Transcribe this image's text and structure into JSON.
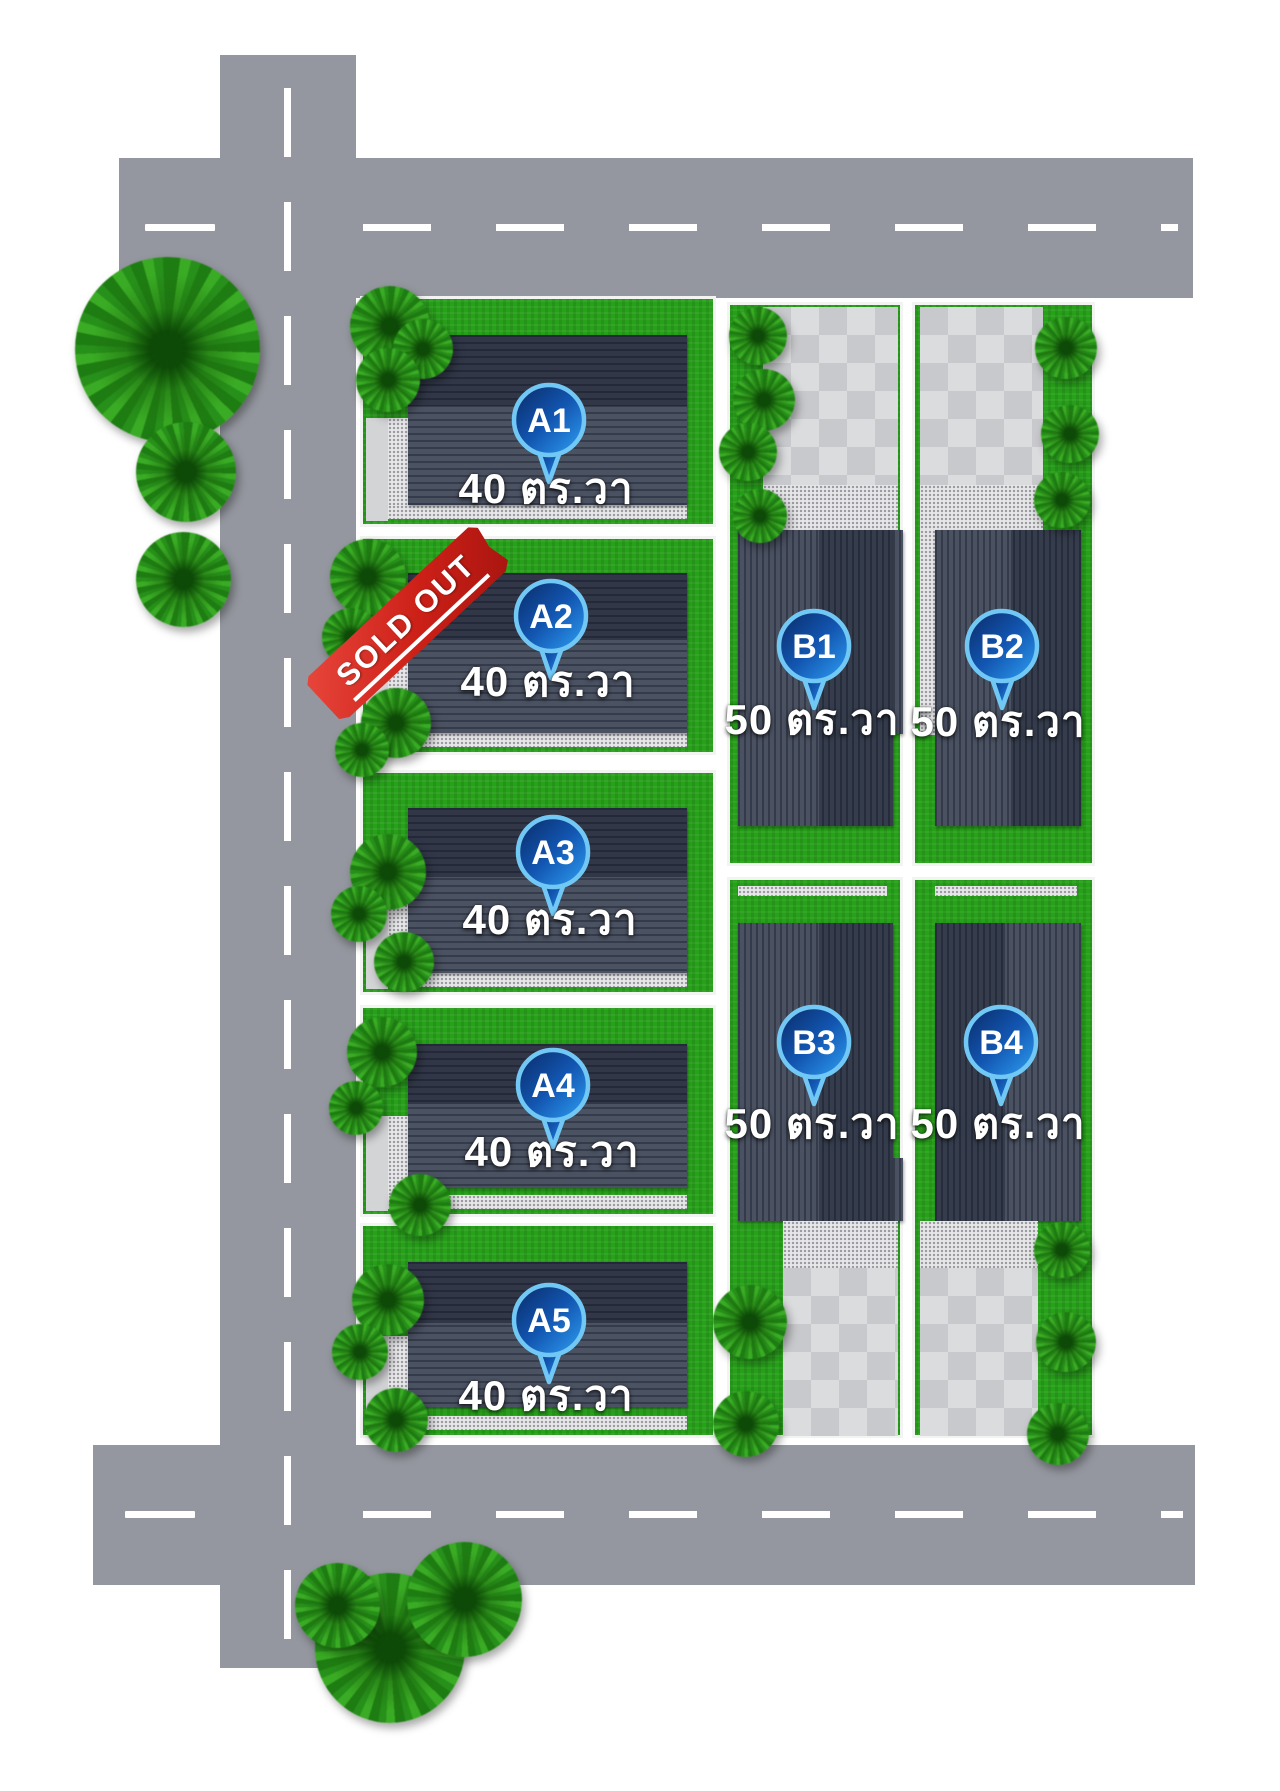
{
  "plan": {
    "type": "housing-project-site-plan",
    "lot_count": 9
  },
  "lots": [
    {
      "id": "A1",
      "area_label": "40 ตร.วา",
      "status": "available"
    },
    {
      "id": "A2",
      "area_label": "40 ตร.วา",
      "status": "sold",
      "banner": "SOLD OUT"
    },
    {
      "id": "A3",
      "area_label": "40 ตร.วา",
      "status": "available"
    },
    {
      "id": "A4",
      "area_label": "40 ตร.วา",
      "status": "available"
    },
    {
      "id": "A5",
      "area_label": "40 ตร.วา",
      "status": "available"
    },
    {
      "id": "B1",
      "area_label": "50 ตร.วา",
      "status": "available"
    },
    {
      "id": "B2",
      "area_label": "50 ตร.วา",
      "status": "available"
    },
    {
      "id": "B3",
      "area_label": "50 ตร.วา",
      "status": "available"
    },
    {
      "id": "B4",
      "area_label": "50 ตร.วา",
      "status": "available"
    }
  ],
  "colors": {
    "road": "#94979f",
    "road_line": "#ffffff",
    "grass": "#27a01a",
    "roof": "#49505e",
    "paving": "#d9dadc",
    "pin_dark_blue": "#0a2a66",
    "pin_light_blue": "#2fa1f5",
    "pin_ring": "#72c8f5",
    "banner_red": "#cc2017",
    "label_text": "#ffffff"
  }
}
